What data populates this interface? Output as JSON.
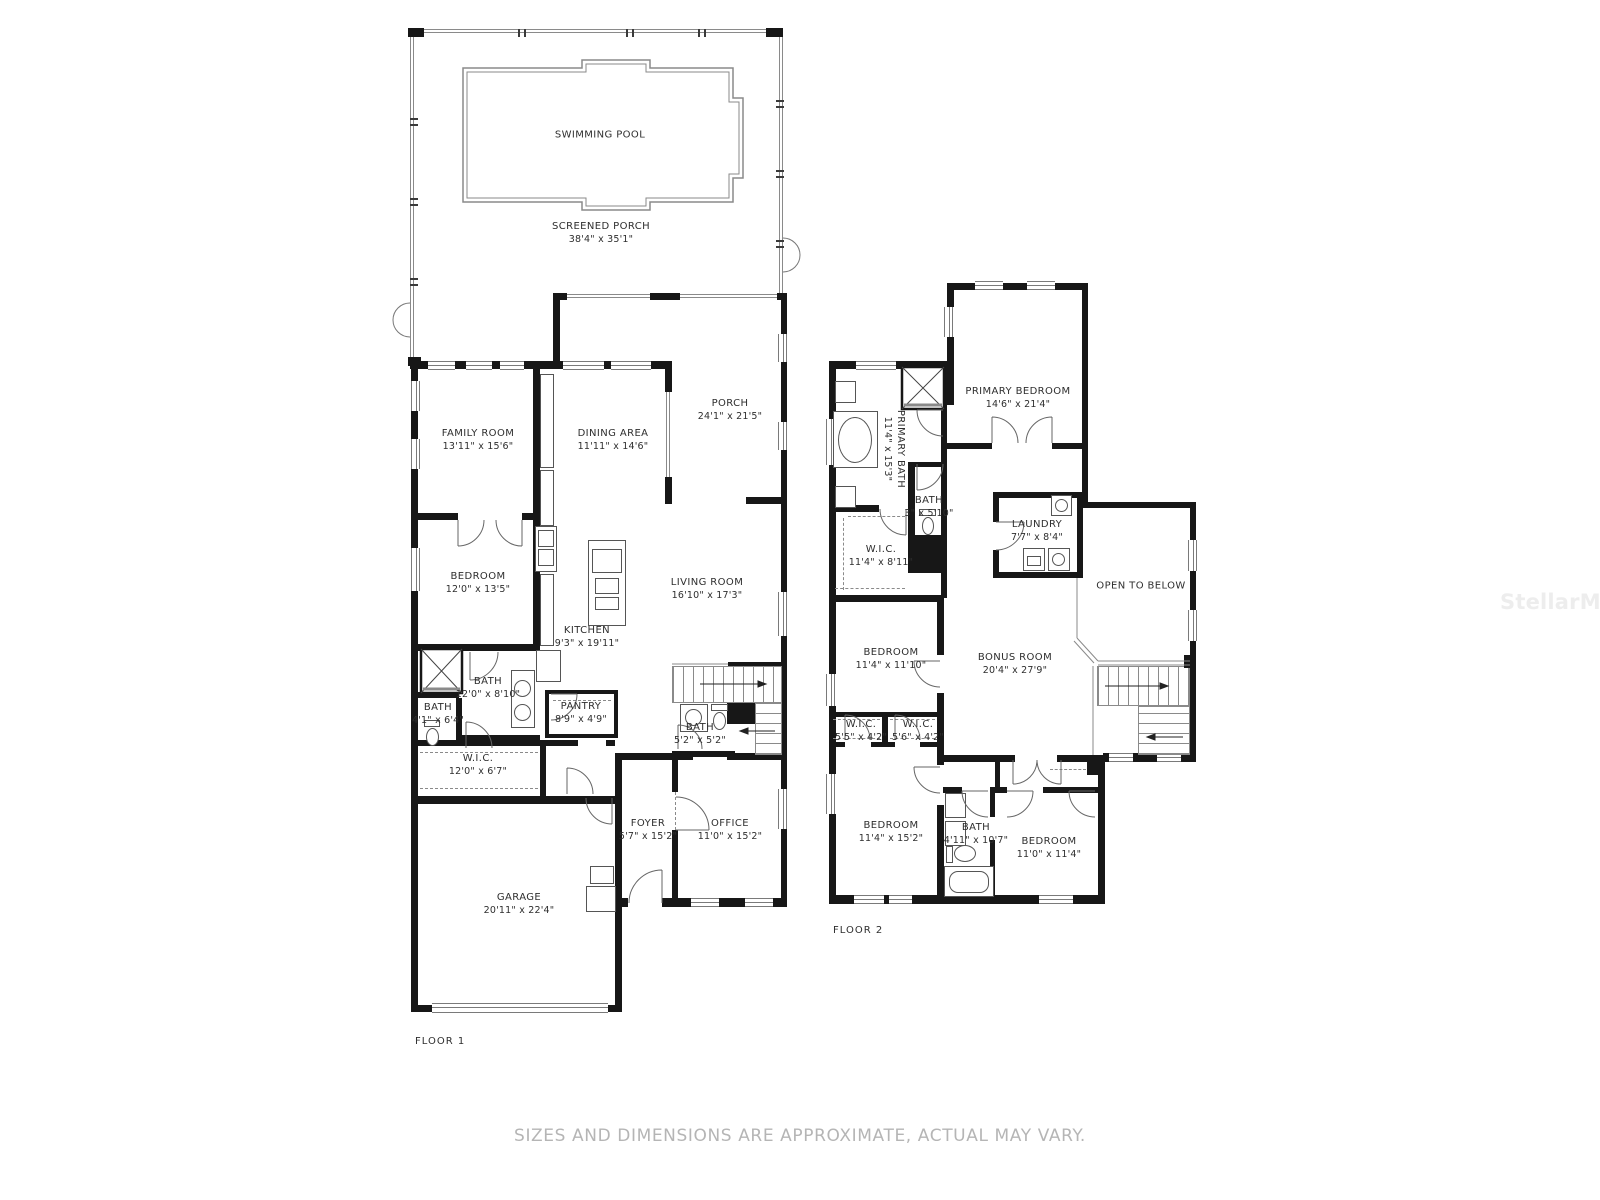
{
  "floor1": {
    "floor_label": "FLOOR 1",
    "swimming_pool": {
      "name": "SWIMMING POOL"
    },
    "screened_porch": {
      "name": "SCREENED PORCH",
      "dims": "38'4\" x 35'1\""
    },
    "family_room": {
      "name": "FAMILY ROOM",
      "dims": "13'11\" x 15'6\""
    },
    "dining_area": {
      "name": "DINING AREA",
      "dims": "11'11\" x 14'6\""
    },
    "porch": {
      "name": "PORCH",
      "dims": "24'1\" x 21'5\""
    },
    "bedroom": {
      "name": "BEDROOM",
      "dims": "12'0\" x 13'5\""
    },
    "kitchen": {
      "name": "KITCHEN",
      "dims": "9'3\" x 19'11\""
    },
    "living_room": {
      "name": "LIVING ROOM",
      "dims": "16'10\" x 17'3\""
    },
    "bath_main": {
      "name": "BATH",
      "dims": "12'0\" x 8'10\""
    },
    "bath_small": {
      "name": "BATH",
      "dims": "4'1\" x 6'4\""
    },
    "pantry": {
      "name": "PANTRY",
      "dims": "8'9\" x 4'9\""
    },
    "bath_stairs": {
      "name": "BATH",
      "dims": "5'2\" x 5'2\""
    },
    "wic": {
      "name": "W.I.C.",
      "dims": "12'0\" x 6'7\""
    },
    "foyer": {
      "name": "FOYER",
      "dims": "5'7\" x 15'2\""
    },
    "office": {
      "name": "OFFICE",
      "dims": "11'0\" x 15'2\""
    },
    "garage": {
      "name": "GARAGE",
      "dims": "20'11\" x 22'4\""
    }
  },
  "floor2": {
    "floor_label": "FLOOR 2",
    "primary_bath": {
      "name": "PRIMARY BATH",
      "dims": "11'4\" x 15'3\""
    },
    "primary_bedroom": {
      "name": "PRIMARY BEDROOM",
      "dims": "14'6\" x 21'4\""
    },
    "bath_small": {
      "name": "BATH",
      "dims": "3\" x 5'10\""
    },
    "laundry": {
      "name": "LAUNDRY",
      "dims": "7'7\" x 8'4\""
    },
    "wic_primary": {
      "name": "W.I.C.",
      "dims": "11'4\" x 8'11\""
    },
    "open_to_below": {
      "name": "OPEN TO BELOW"
    },
    "bedroom_a": {
      "name": "BEDROOM",
      "dims": "11'4\" x 11'10\""
    },
    "bonus_room": {
      "name": "BONUS ROOM",
      "dims": "20'4\" x 27'9\""
    },
    "wic_a": {
      "name": "W.I.C.",
      "dims": "5'5\" x 4'2\""
    },
    "wic_b": {
      "name": "W.I.C.",
      "dims": "5'6\" x 4'2\""
    },
    "bedroom_b": {
      "name": "BEDROOM",
      "dims": "11'4\" x 15'2\""
    },
    "bath_hall": {
      "name": "BATH",
      "dims": "4'11\" x 10'7\""
    },
    "bedroom_c": {
      "name": "BEDROOM",
      "dims": "11'0\" x 11'4\""
    }
  },
  "footer": {
    "disclaimer": "SIZES AND DIMENSIONS ARE APPROXIMATE, ACTUAL MAY VARY."
  },
  "watermark": "StellarMLS"
}
